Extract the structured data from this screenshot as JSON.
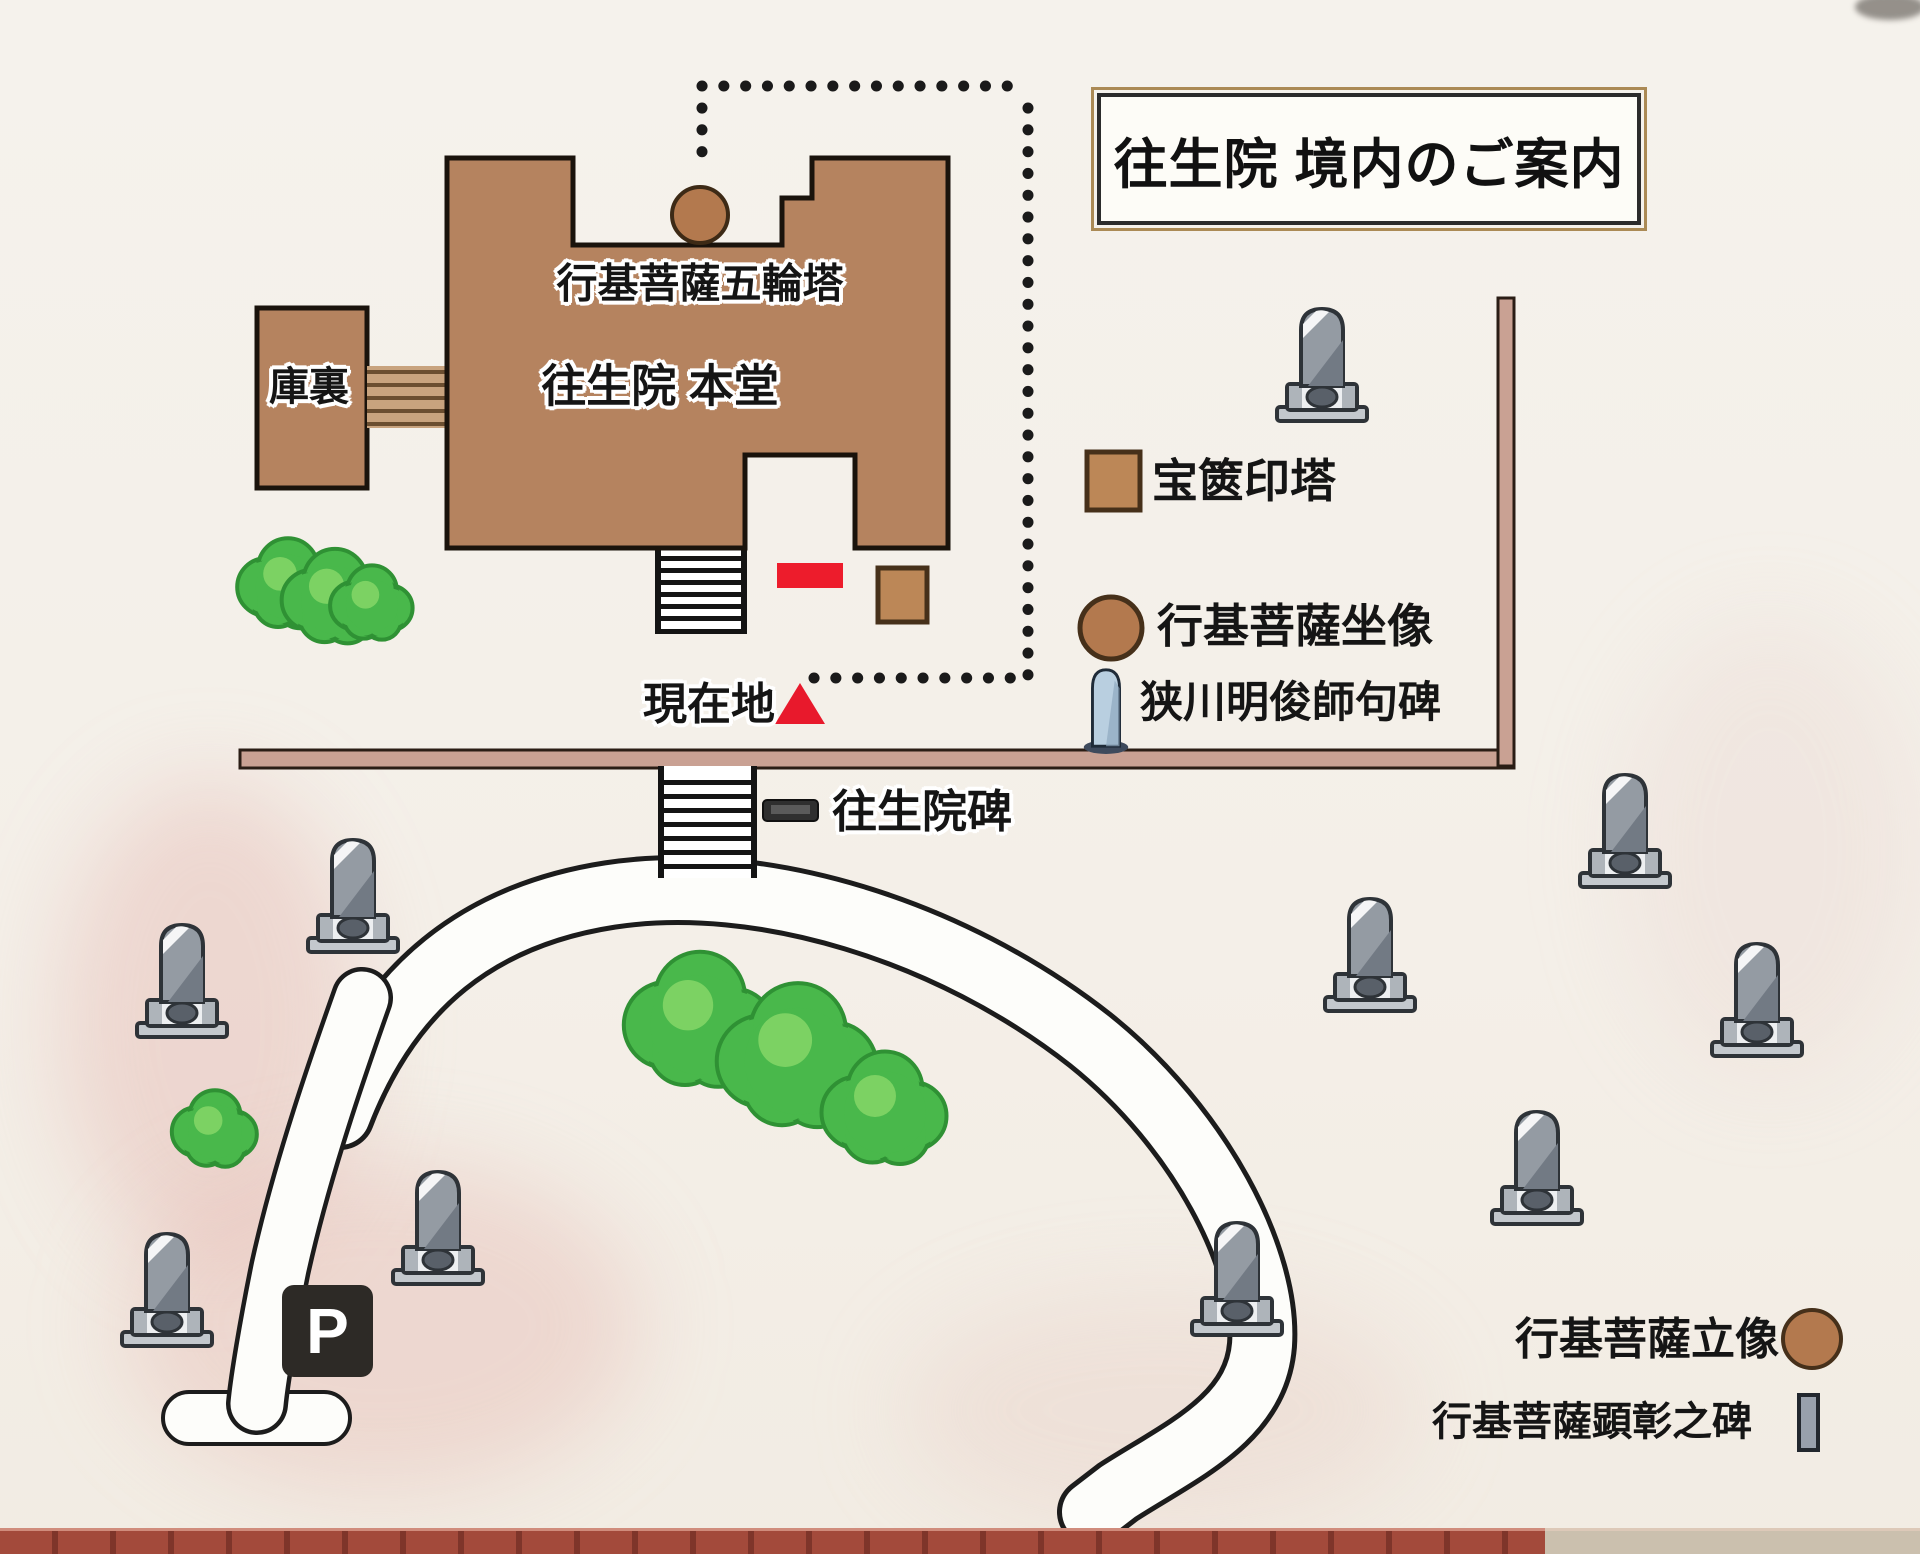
{
  "title": "往生院 境内のご案内",
  "map_labels": {
    "gorinto": "行基菩薩五輪塔",
    "hondo": "往生院 本堂",
    "kuri": "庫裏",
    "current_location": "現在地",
    "ojoin_monument": "往生院碑",
    "parking": "P"
  },
  "legend": {
    "items": [
      {
        "icon": "brown-square",
        "label": "宝篋印塔"
      },
      {
        "icon": "brown-circle",
        "label": "行基菩薩坐像"
      },
      {
        "icon": "stone-statue",
        "label": "狭川明俊師句碑"
      }
    ],
    "bottom_items": [
      {
        "icon": "brown-circle",
        "label": "行基菩薩立像"
      },
      {
        "icon": "grey-stele",
        "label": "行基菩薩顕彰之碑"
      }
    ]
  },
  "colors": {
    "building_brown": "#b5835f",
    "icon_brown": "#bc8757",
    "accent_red": "#ed1c2c",
    "wall_tan": "#c9a193",
    "stone_grey": "#949ba3",
    "tree_green": "#49b84b",
    "paper": "#f4f0e9",
    "brick": "#a34a3b",
    "parking_black": "#2d2a26"
  },
  "map_data": {
    "tombstones": [
      [
        1322,
        362
      ],
      [
        353,
        893
      ],
      [
        182,
        978
      ],
      [
        167,
        1287
      ],
      [
        438,
        1225
      ],
      [
        1625,
        828
      ],
      [
        1370,
        952
      ],
      [
        1757,
        997
      ],
      [
        1537,
        1165
      ],
      [
        1237,
        1276
      ]
    ],
    "trees": [
      [
        288,
        585,
        40
      ],
      [
        335,
        598,
        42
      ],
      [
        372,
        604,
        33
      ],
      [
        215,
        1130,
        34
      ],
      [
        700,
        1022,
        60
      ],
      [
        798,
        1058,
        64
      ],
      [
        885,
        1110,
        50
      ]
    ]
  }
}
